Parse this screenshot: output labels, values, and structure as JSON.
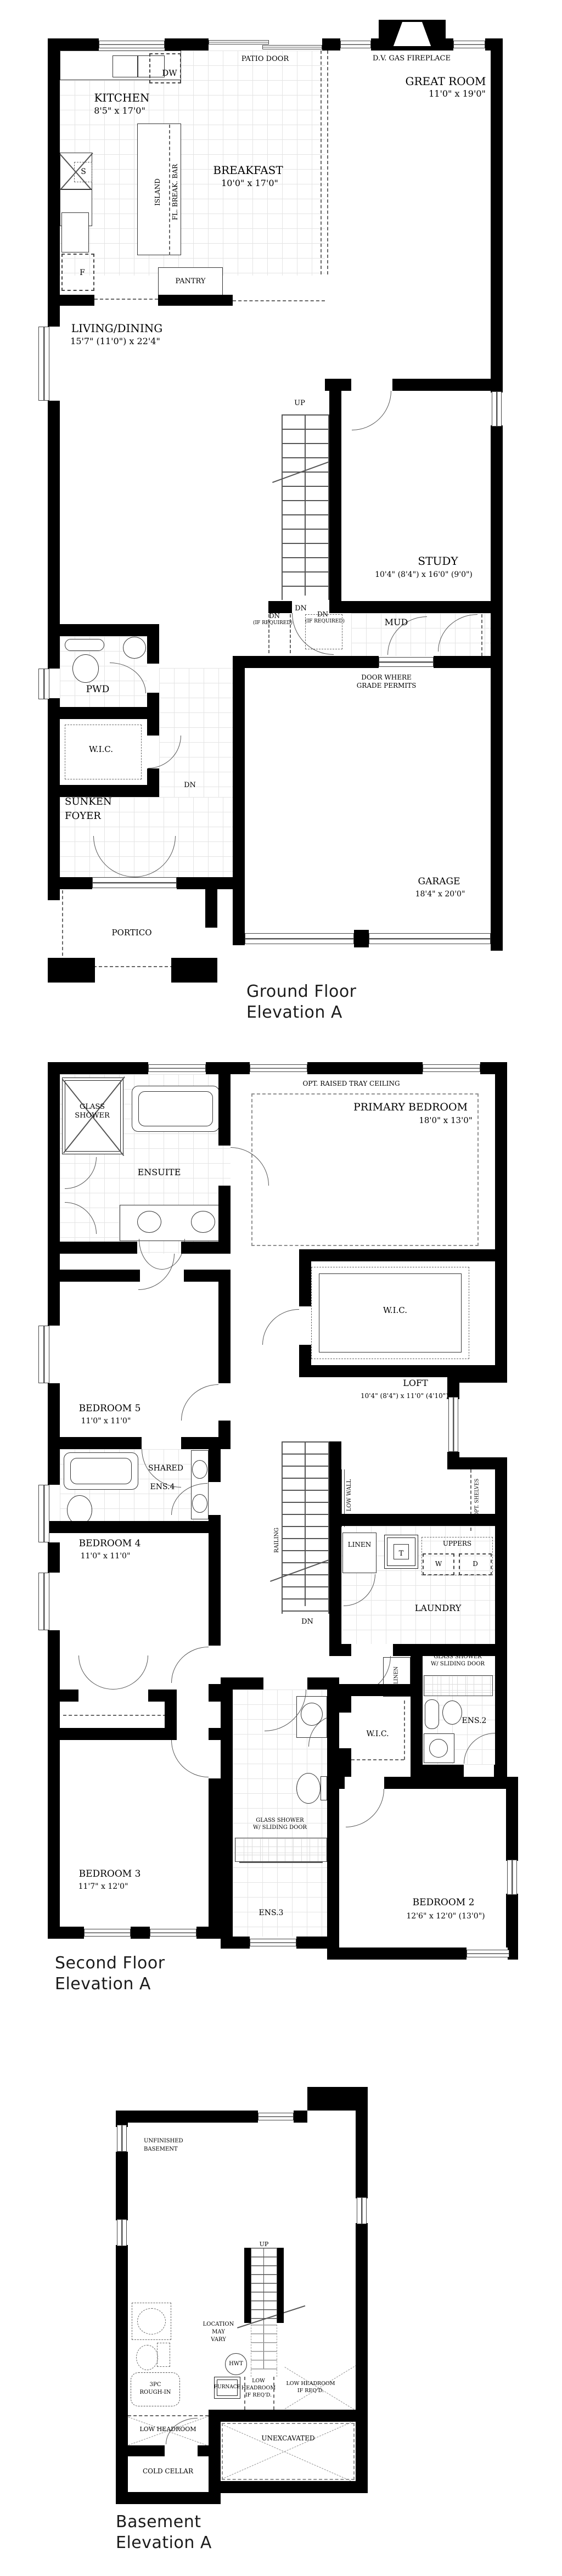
{
  "sheets": {
    "ground": {
      "title1": "Ground Floor",
      "title2": "Elevation A",
      "labels": {
        "patio_door": "PATIO DOOR",
        "dw": "DW",
        "fireplace": "D.V. GAS FIREPLACE",
        "great_room": "GREAT ROOM",
        "great_room_dims": "11'0\" x 19'0\"",
        "kitchen": "KITCHEN",
        "kitchen_dims": "8'5\" x 17'0\"",
        "s": "S",
        "island": "ISLAND",
        "fl_break_bar": "FL. BREAK. BAR",
        "breakfast": "BREAKFAST",
        "breakfast_dims": "10'0\" x 17'0\"",
        "f": "F",
        "pantry": "PANTRY",
        "living_dining": "LIVING/DINING",
        "living_dining_dims": "15'7\" (11'0\") x 22'4\"",
        "up": "UP",
        "study": "STUDY",
        "study_dims": "10'4\" (8'4\") x 16'0\" (9'0\")",
        "dn": "DN",
        "dn_req1": "DN",
        "if_req1": "(IF REQUIRED)",
        "dn_req2": "DN",
        "if_req2": "(IF REQUIRED)",
        "mud": "MUD",
        "door_grade1": "DOOR WHERE",
        "door_grade2": "GRADE PERMITS",
        "pwd": "PWD",
        "wic": "W.I.C.",
        "dn_foyer": "DN",
        "sunken": "SUNKEN",
        "foyer": "FOYER",
        "portico": "PORTICO",
        "garage": "GARAGE",
        "garage_dims": "18'4\" x 20'0\""
      }
    },
    "second": {
      "title1": "Second Floor",
      "title2": "Elevation A",
      "labels": {
        "glass1": "GLASS",
        "shower1": "SHOWER",
        "ensuite": "ENSUITE",
        "opt_tray": "OPT. RAISED TRAY CEILING",
        "primary": "PRIMARY BEDROOM",
        "primary_dims": "18'0\" x 13'0\"",
        "wic_primary": "W.I.C.",
        "loft": "LOFT",
        "loft_dims": "10'4\" (8'4\") x 11'0\" (4'10\")",
        "bedroom5": "BEDROOM 5",
        "bedroom5_dims": "11'0\" x 11'0\"",
        "shared": "SHARED",
        "ens4": "ENS.4",
        "bedroom4": "BEDROOM 4",
        "bedroom4_dims": "11'0\" x 11'0\"",
        "railing": "RAILING",
        "low_wall": "LOW WALL",
        "dn": "DN",
        "linen": "LINEN",
        "t": "T",
        "uppers": "UPPERS",
        "w": "W",
        "d": "D",
        "opt_shelves": "OPT. SHELVES",
        "laundry": "LAUNDRY",
        "glass_shower2a": "GLASS SHOWER",
        "glass_shower2b": "W/ SLIDING DOOR",
        "ens2": "ENS.2",
        "linen2": "LINEN",
        "wic_bed2": "W.I.C.",
        "glass_shower3a": "GLASS SHOWER",
        "glass_shower3b": "W/ SLIDING DOOR",
        "ens3": "ENS.3",
        "bedroom3": "BEDROOM 3",
        "bedroom3_dims": "11'7\" x 12'0\"",
        "bedroom2": "BEDROOM 2",
        "bedroom2_dims": "12'6\" x 12'0\" (13'0\")"
      }
    },
    "basement": {
      "title1": "Basement",
      "title2": "Elevation A",
      "labels": {
        "unfinished1": "UNFINISHED",
        "unfinished2": "BASEMENT",
        "up": "UP",
        "location1": "LOCATION",
        "location2": "MAY",
        "location3": "VARY",
        "hwt": "HWT",
        "furnace": "FURNACE",
        "low1a": "LOW",
        "low1b": "HEADROOM",
        "low1c": "IF REQ'D.",
        "low2a": "LOW HEADROOM",
        "low2b": "IF REQ'D.",
        "threepc1": "3PC",
        "threepc2": "ROUGH-IN",
        "low_headroom": "LOW HEADROOM",
        "cold_cellar": "COLD CELLAR",
        "unexcavated": "UNEXCAVATED"
      }
    }
  }
}
